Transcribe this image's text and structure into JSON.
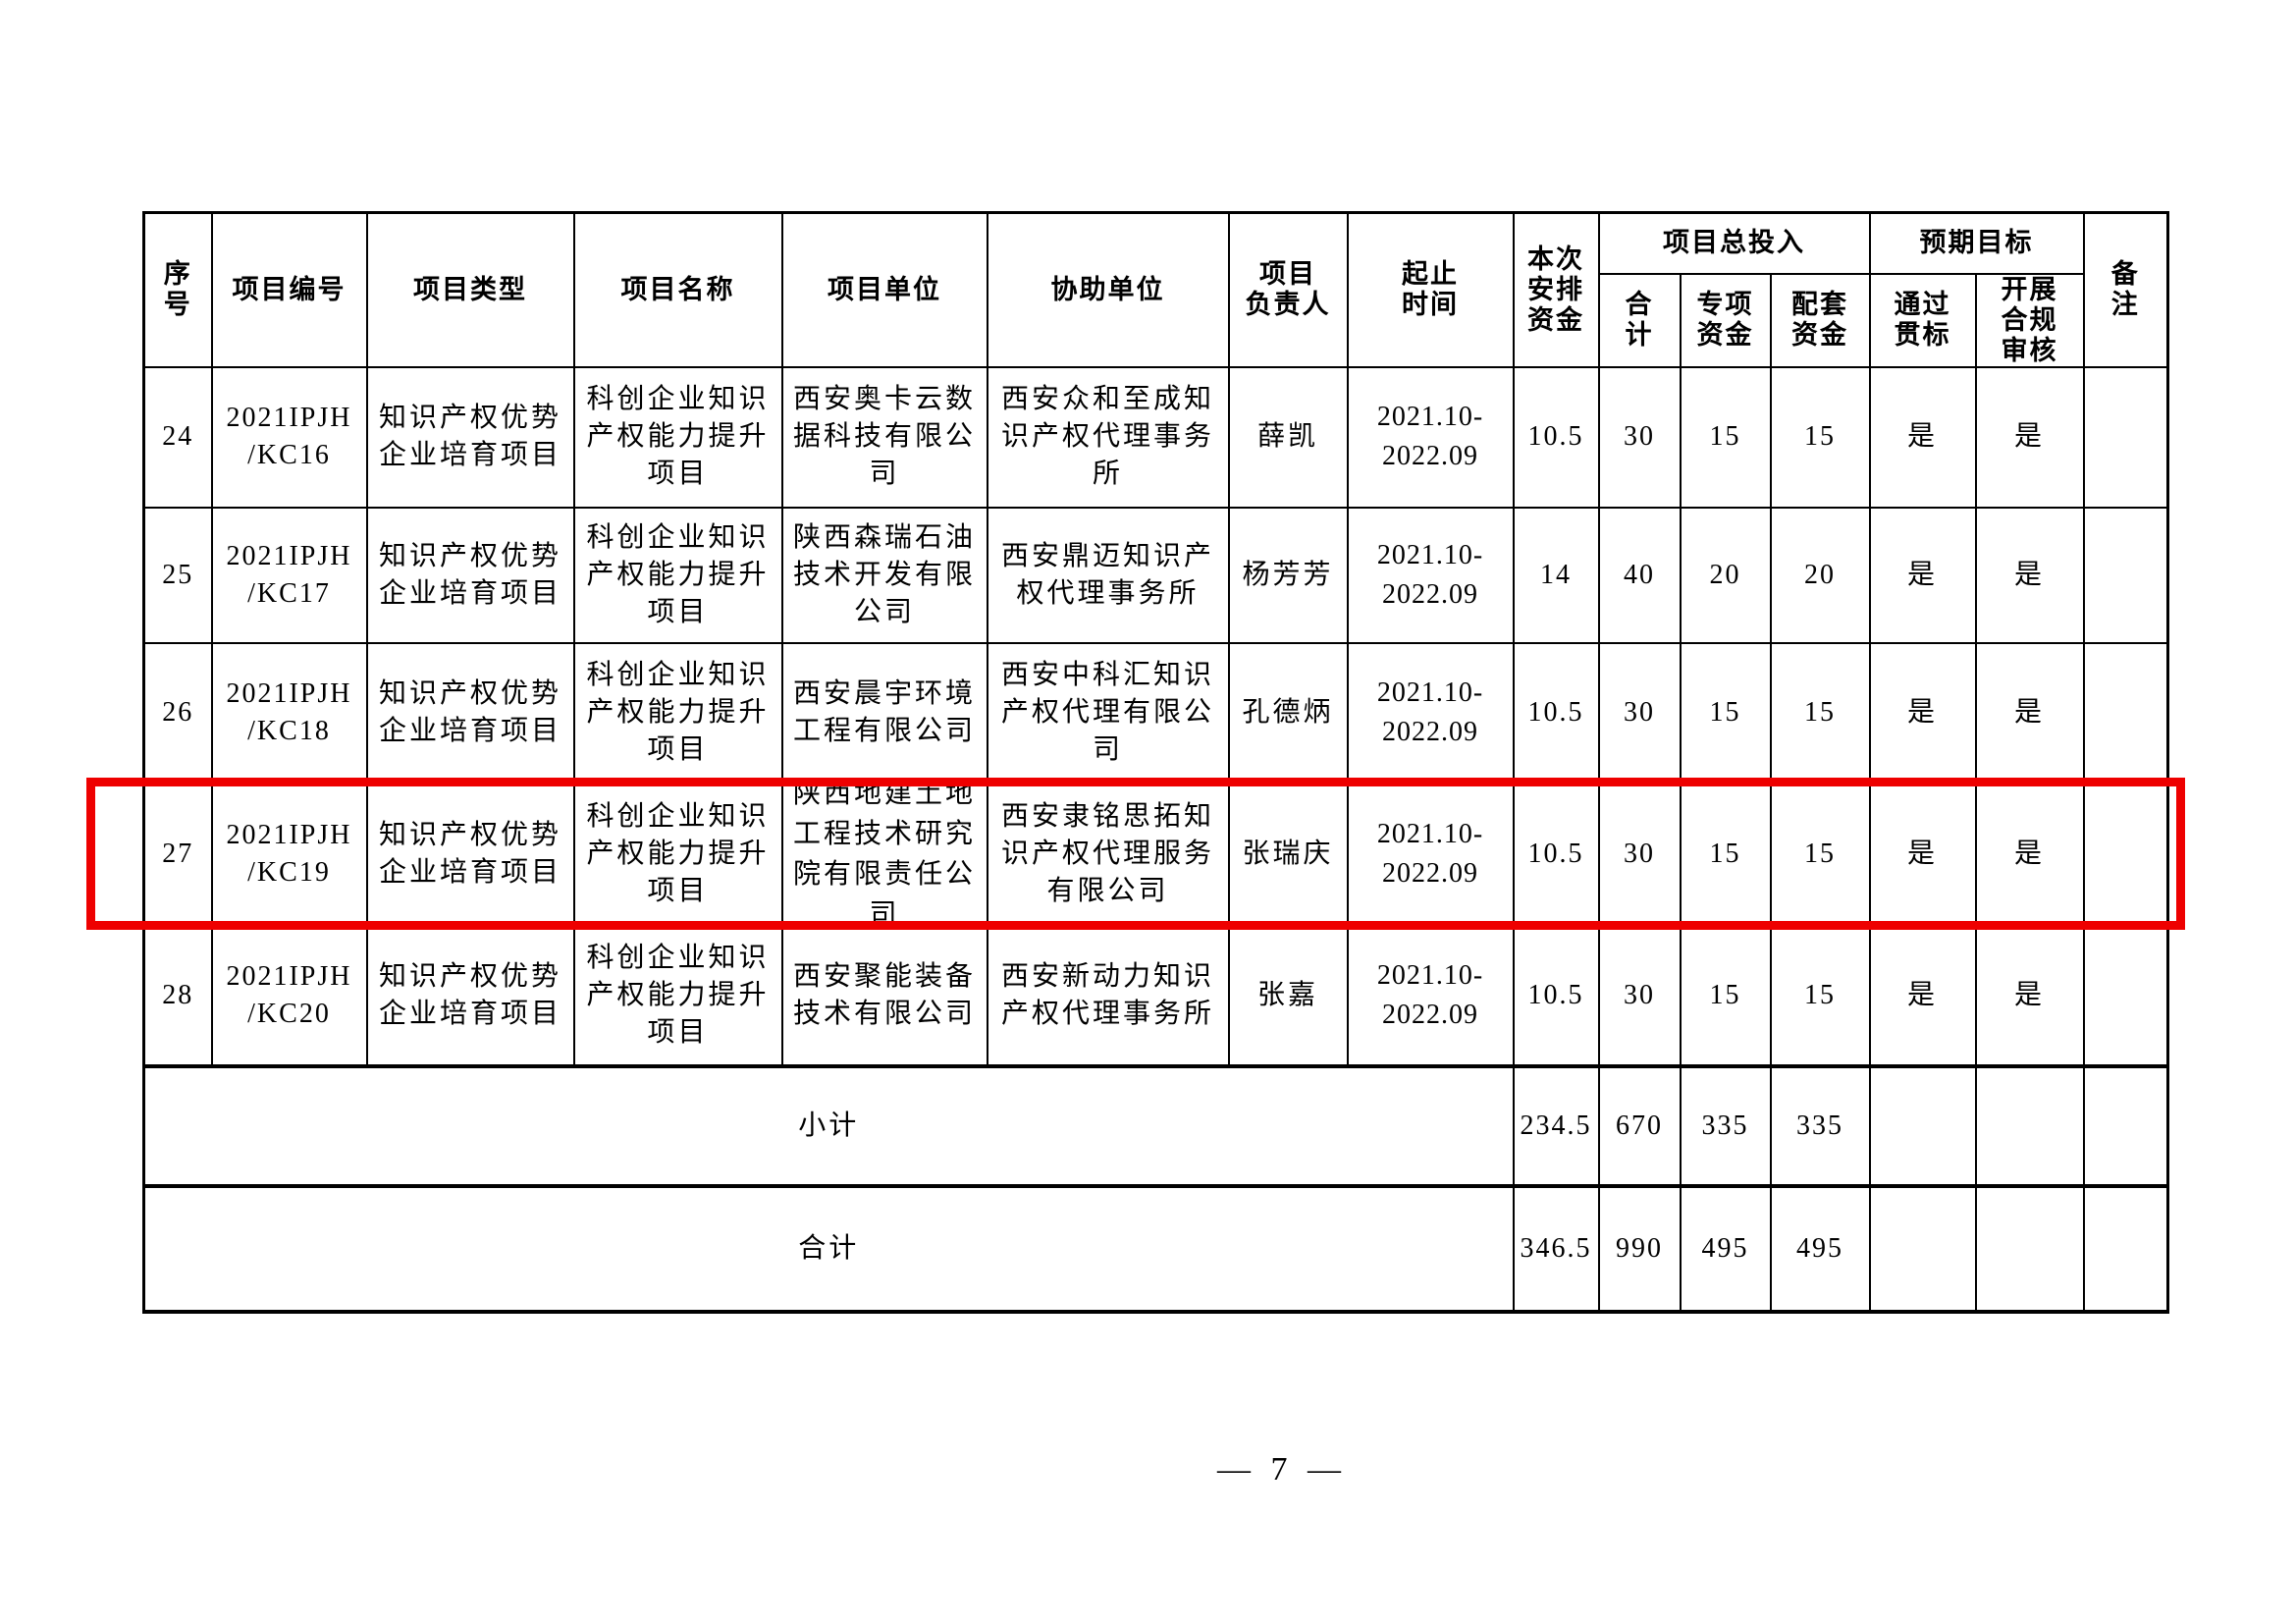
{
  "page": {
    "page_number": "— 7 —"
  },
  "highlight": {
    "color": "#ee0000"
  },
  "table": {
    "headers": {
      "serial": "序\n号",
      "project_code": "项目编号",
      "project_type": "项目类型",
      "project_name": "项目名称",
      "project_unit": "项目单位",
      "assist_unit": "协助单位",
      "project_leader": "项目\n负责人",
      "period": "起止\n时间",
      "current_fund": "本次\n安排\n资金",
      "total_investment_group": "项目总投入",
      "total": "合\n计",
      "special_fund": "专项\n资金",
      "matching_fund": "配套\n资金",
      "expected_goal_group": "预期目标",
      "pass_standard": "通过\n贯标",
      "compliance_review": "开展\n合规\n审核",
      "remark": "备\n注"
    },
    "rows": [
      {
        "serial": "24",
        "code": "2021IPJH\n/KC16",
        "type": "知识产权优势\n企业培育项目",
        "name": "科创企业知识\n产权能力提升\n项目",
        "unit": "西安奥卡云数\n据科技有限公\n司",
        "assist": "西安众和至成知\n识产权代理事务\n所",
        "leader": "薛凯",
        "period": "2021.10-\n2022.09",
        "fund": "10.5",
        "total": "30",
        "special": "15",
        "matching": "15",
        "pass": "是",
        "review": "是",
        "remark": ""
      },
      {
        "serial": "25",
        "code": "2021IPJH\n/KC17",
        "type": "知识产权优势\n企业培育项目",
        "name": "科创企业知识\n产权能力提升\n项目",
        "unit": "陕西森瑞石油\n技术开发有限\n公司",
        "assist": "西安鼎迈知识产\n权代理事务所",
        "leader": "杨芳芳",
        "period": "2021.10-\n2022.09",
        "fund": "14",
        "total": "40",
        "special": "20",
        "matching": "20",
        "pass": "是",
        "review": "是",
        "remark": ""
      },
      {
        "serial": "26",
        "code": "2021IPJH\n/KC18",
        "type": "知识产权优势\n企业培育项目",
        "name": "科创企业知识\n产权能力提升\n项目",
        "unit": "西安晨宇环境\n工程有限公司",
        "assist": "西安中科汇知识\n产权代理有限公\n司",
        "leader": "孔德炳",
        "period": "2021.10-\n2022.09",
        "fund": "10.5",
        "total": "30",
        "special": "15",
        "matching": "15",
        "pass": "是",
        "review": "是",
        "remark": ""
      },
      {
        "serial": "27",
        "code": "2021IPJH\n/KC19",
        "type": "知识产权优势\n企业培育项目",
        "name": "科创企业知识\n产权能力提升\n项目",
        "unit": "陕西地建土地\n工程技术研究\n院有限责任公\n司",
        "assist": "西安隶铭思拓知\n识产权代理服务\n有限公司",
        "leader": "张瑞庆",
        "period": "2021.10-\n2022.09",
        "fund": "10.5",
        "total": "30",
        "special": "15",
        "matching": "15",
        "pass": "是",
        "review": "是",
        "remark": ""
      },
      {
        "serial": "28",
        "code": "2021IPJH\n/KC20",
        "type": "知识产权优势\n企业培育项目",
        "name": "科创企业知识\n产权能力提升\n项目",
        "unit": "西安聚能装备\n技术有限公司",
        "assist": "西安新动力知识\n产权代理事务所",
        "leader": "张嘉",
        "period": "2021.10-\n2022.09",
        "fund": "10.5",
        "total": "30",
        "special": "15",
        "matching": "15",
        "pass": "是",
        "review": "是",
        "remark": ""
      }
    ],
    "subtotal": {
      "label": "小计",
      "fund": "234.5",
      "total": "670",
      "special": "335",
      "matching": "335",
      "pass": "",
      "review": "",
      "remark": ""
    },
    "grand_total": {
      "label": "合计",
      "fund": "346.5",
      "total": "990",
      "special": "495",
      "matching": "495",
      "pass": "",
      "review": "",
      "remark": ""
    }
  }
}
